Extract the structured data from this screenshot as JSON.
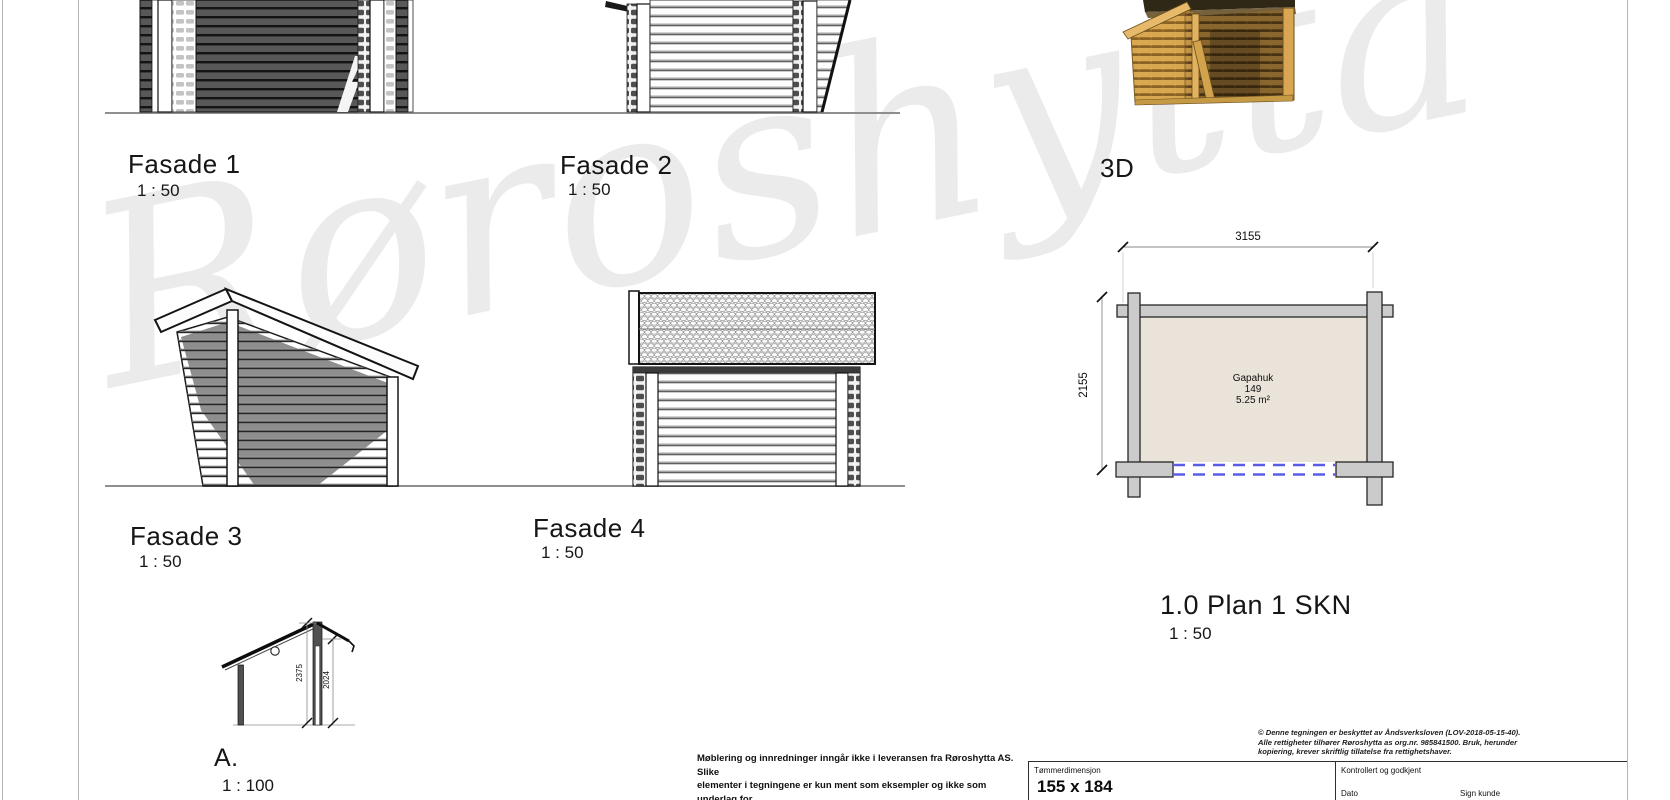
{
  "watermark": "Røroshytta",
  "views": {
    "fasade1": {
      "label": "Fasade 1",
      "scale": "1 : 50"
    },
    "fasade2": {
      "label": "Fasade 2",
      "scale": "1 : 50"
    },
    "view3d": {
      "label": "3D"
    },
    "fasade3": {
      "label": "Fasade 3",
      "scale": "1 : 50"
    },
    "fasade4": {
      "label": "Fasade 4",
      "scale": "1 : 50"
    },
    "plan": {
      "label": "1.0 Plan 1 SKN",
      "scale": "1 : 50"
    },
    "section": {
      "label": "A.",
      "scale": "1 : 100"
    }
  },
  "plan_view": {
    "dim_width": "3155",
    "dim_depth": "2155",
    "room": {
      "name": "Gapahuk",
      "number": "149",
      "area": "5.25 m²"
    }
  },
  "section_view": {
    "dim_total_height": "2375",
    "dim_eave_height": "2024"
  },
  "disclaimer": "Møblering og innredninger inngår ikke i leveransen fra Røroshytta AS. Slike\nelementer i tegningene er kun ment som eksempler og ikke som underlag for\nelektriker, rørlegger m.v.",
  "titleblock": {
    "copyright": "© Denne tegningen er beskyttet av Åndsverksloven (LOV-2018-05-15-40).\nAlle rettigheter tilhører Røroshytta as org.nr. 985841500. Bruk, herunder\nkopiering, krever skriftlig tillatelse fra rettighetshaver.",
    "timber_dimension_label": "Tømmerdimensjon",
    "timber_dimension_value": "155 x 184",
    "approved_label": "Kontrollert og godkjent",
    "date_label": "Dato",
    "sign_label": "Sign kunde"
  },
  "colors": {
    "overhang_dash": "#5b5bea",
    "plan_wall_fill": "#cbcbcb",
    "plan_room_fill": "#e9e3d9",
    "wood": "#d8a750",
    "watermark_gray": "#e7e7e7"
  }
}
